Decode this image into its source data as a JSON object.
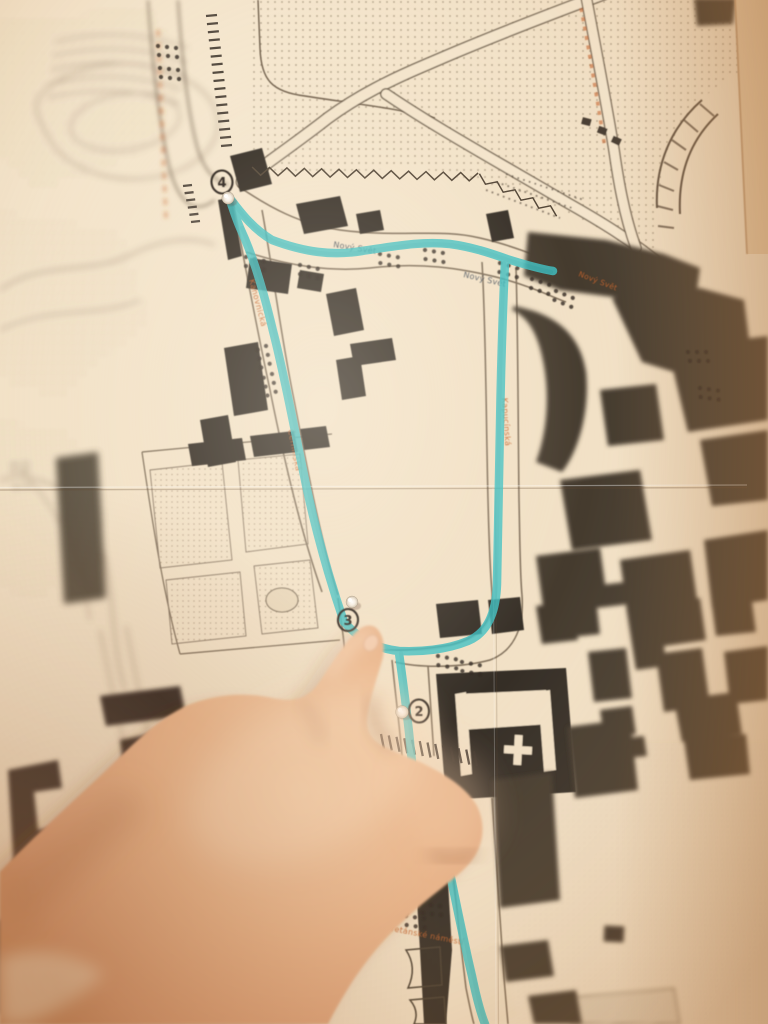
{
  "map": {
    "street_labels": [
      {
        "id": "novy-svet-1",
        "text": "Nový Svět"
      },
      {
        "id": "novy-svet-2",
        "text": "Nový Svět"
      },
      {
        "id": "novy-svet-3",
        "text": "Nový Svět"
      },
      {
        "id": "kanovnicka",
        "text": "Kanovnická"
      },
      {
        "id": "cerninska",
        "text": "Černínská"
      },
      {
        "id": "kapucinska",
        "text": "Kapucínská"
      },
      {
        "id": "loretanske-namesti",
        "text": "Loretánské náměstí"
      }
    ],
    "route_markers": [
      {
        "number": "4"
      },
      {
        "number": "3"
      },
      {
        "number": "2"
      }
    ],
    "colors": {
      "route_highlight": "#3fc0c3",
      "street_label_orange": "#c4632d",
      "street_label_dark": "#46505c",
      "ink": "#2b231b",
      "paper": "#f2e1c6"
    }
  }
}
